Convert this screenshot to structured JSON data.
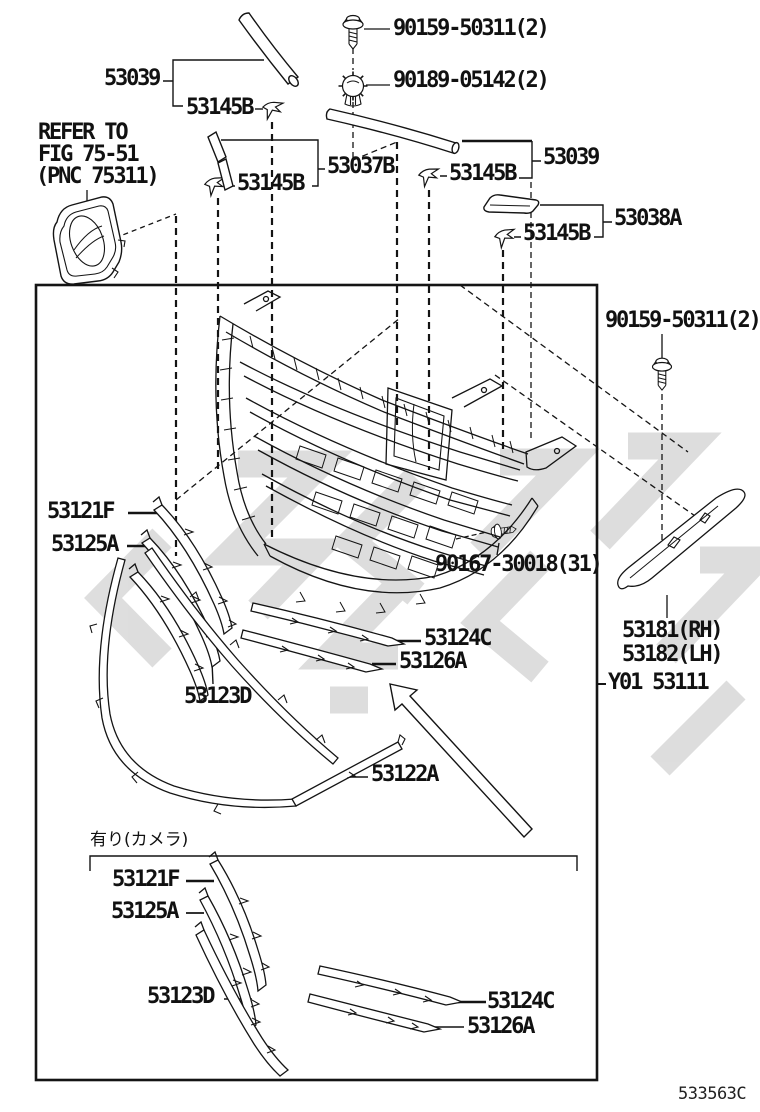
{
  "diagram": {
    "doc_code": "533563C",
    "camera_note": "有り(カメラ)",
    "figure_note": [
      "REFER TO",
      "FIG 75-51",
      "(PNC 75311)"
    ],
    "part_numbers": [
      "90159-50311(2)",
      "90189-05142(2)",
      "53039",
      "53145B",
      "53037B",
      "53038A",
      "90167-30018(31)",
      "53121F",
      "53125A",
      "53123D",
      "53124C",
      "53126A",
      "53122A",
      "53181(RH)",
      "53182(LH)",
      "Y01 53111"
    ],
    "callouts": [
      {
        "id": "pn-90159-50311-top",
        "text": "90159-50311(2)",
        "x": 393,
        "y": 18,
        "kind": "pn"
      },
      {
        "id": "pn-90189-05142",
        "text": "90189-05142(2)",
        "x": 393,
        "y": 70,
        "kind": "pn"
      },
      {
        "id": "pn-53039-left",
        "text": "53039",
        "x": 104,
        "y": 68,
        "kind": "pn"
      },
      {
        "id": "pn-53145b-1",
        "text": "53145B",
        "x": 186,
        "y": 97,
        "kind": "pn"
      },
      {
        "id": "refer-note-line1",
        "text": "REFER TO",
        "x": 38,
        "y": 122,
        "kind": "pn"
      },
      {
        "id": "refer-note-line2",
        "text": "FIG 75-51",
        "x": 38,
        "y": 144,
        "kind": "pn"
      },
      {
        "id": "refer-note-line3",
        "text": "(PNC 75311)",
        "x": 36,
        "y": 166,
        "kind": "pn"
      },
      {
        "id": "pn-53145b-2",
        "text": "53145B",
        "x": 237,
        "y": 173,
        "kind": "pn"
      },
      {
        "id": "pn-53037b",
        "text": "53037B",
        "x": 327,
        "y": 156,
        "kind": "pn"
      },
      {
        "id": "pn-53145b-3",
        "text": "53145B",
        "x": 449,
        "y": 163,
        "kind": "pn"
      },
      {
        "id": "pn-53039-right",
        "text": "53039",
        "x": 543,
        "y": 147,
        "kind": "pn"
      },
      {
        "id": "pn-53038a",
        "text": "53038A",
        "x": 614,
        "y": 208,
        "kind": "pn"
      },
      {
        "id": "pn-53145b-4",
        "text": "53145B",
        "x": 523,
        "y": 223,
        "kind": "pn"
      },
      {
        "id": "pn-90159-50311-right",
        "text": "90159-50311(2)",
        "x": 605,
        "y": 310,
        "kind": "pn"
      },
      {
        "id": "pn-53121f-top",
        "text": "53121F",
        "x": 47,
        "y": 501,
        "kind": "pn"
      },
      {
        "id": "pn-53125a-top",
        "text": "53125A",
        "x": 51,
        "y": 534,
        "kind": "pn"
      },
      {
        "id": "pn-90167-30018",
        "text": "90167-30018(31)",
        "x": 435,
        "y": 554,
        "kind": "pn"
      },
      {
        "id": "pn-53124c-top",
        "text": "53124C",
        "x": 424,
        "y": 628,
        "kind": "pn"
      },
      {
        "id": "pn-53126a-top",
        "text": "53126A",
        "x": 399,
        "y": 651,
        "kind": "pn"
      },
      {
        "id": "pn-53123d-top",
        "text": "53123D",
        "x": 184,
        "y": 686,
        "kind": "pn"
      },
      {
        "id": "pn-53181-rh",
        "text": "53181(RH)",
        "x": 622,
        "y": 620,
        "kind": "pn"
      },
      {
        "id": "pn-53182-lh",
        "text": "53182(LH)",
        "x": 622,
        "y": 644,
        "kind": "pn"
      },
      {
        "id": "pn-y01-53111",
        "text": "Y01 53111",
        "x": 608,
        "y": 672,
        "kind": "pn"
      },
      {
        "id": "pn-53122a",
        "text": "53122A",
        "x": 371,
        "y": 764,
        "kind": "pn"
      },
      {
        "id": "camera-note",
        "text": "有り(カメラ)",
        "x": 90,
        "y": 832,
        "kind": "note"
      },
      {
        "id": "pn-53121f-bottom",
        "text": "53121F",
        "x": 112,
        "y": 869,
        "kind": "pn"
      },
      {
        "id": "pn-53125a-bottom",
        "text": "53125A",
        "x": 111,
        "y": 901,
        "kind": "pn"
      },
      {
        "id": "pn-53123d-bottom",
        "text": "53123D",
        "x": 147,
        "y": 986,
        "kind": "pn"
      },
      {
        "id": "pn-53124c-bottom",
        "text": "53124C",
        "x": 487,
        "y": 991,
        "kind": "pn"
      },
      {
        "id": "pn-53126a-bottom",
        "text": "53126A",
        "x": 467,
        "y": 1016,
        "kind": "pn"
      },
      {
        "id": "doc-code",
        "text": "533563C",
        "x": 678,
        "y": 1086,
        "kind": "code"
      }
    ]
  },
  "colors": {
    "line": "#141414",
    "watermark": "#c2c2c2",
    "background": "#ffffff"
  }
}
